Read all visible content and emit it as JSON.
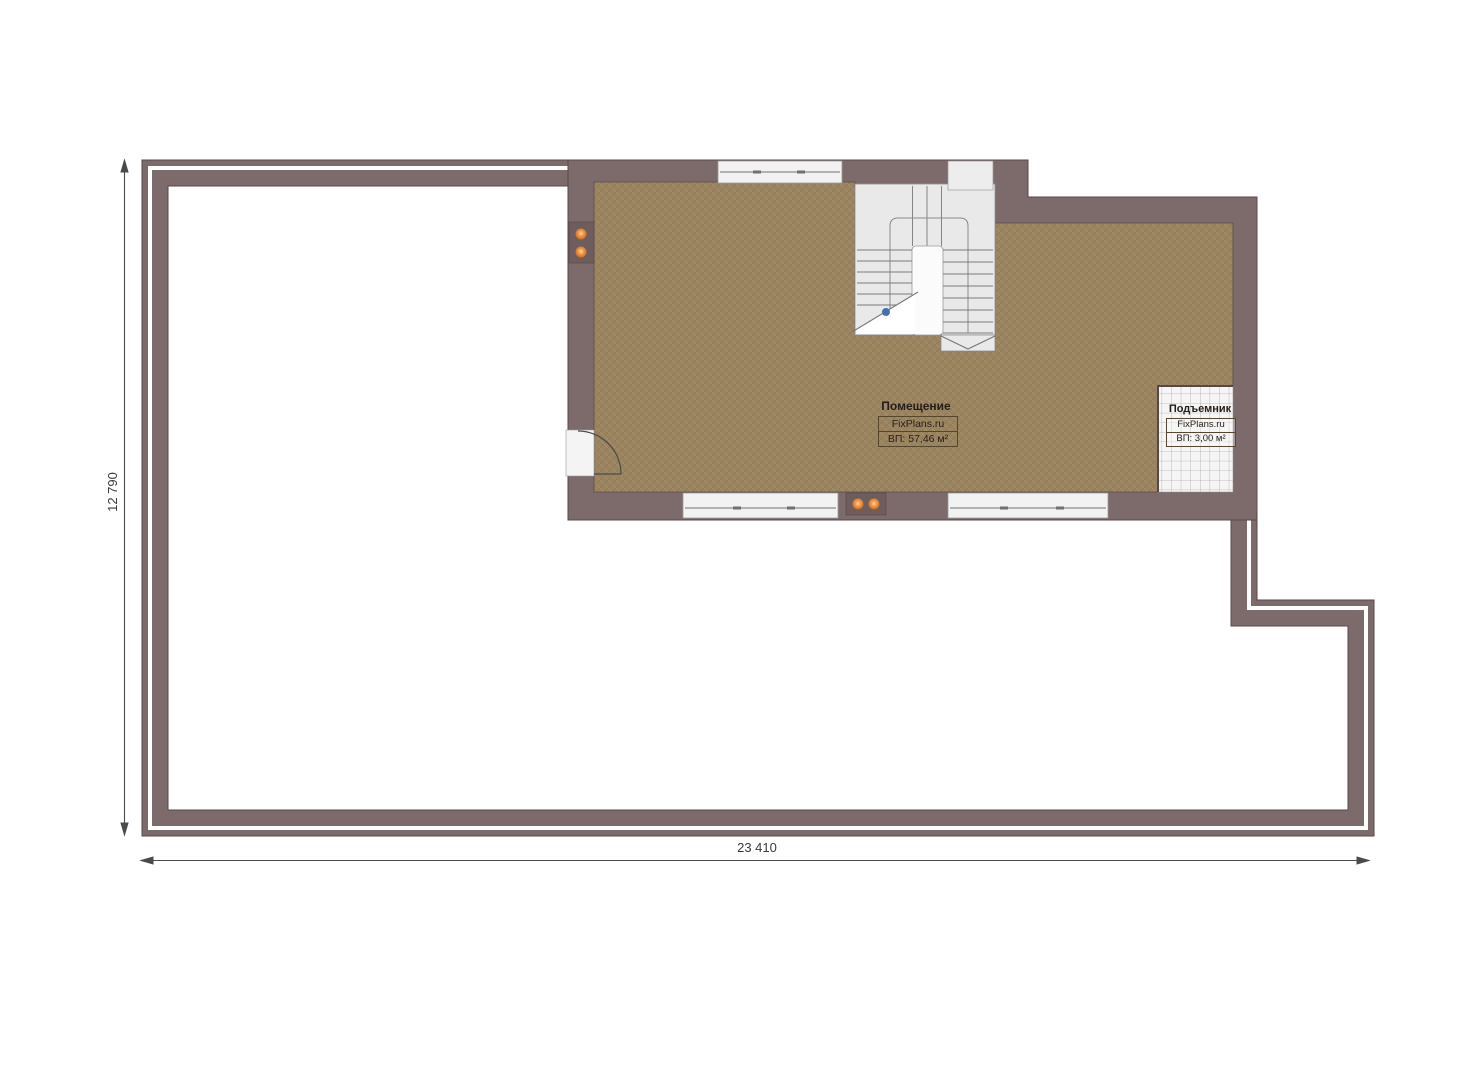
{
  "room": {
    "title": "Помещение",
    "brand": "FixPlans.ru",
    "area": "ВП: 57,46 м²"
  },
  "elevator": {
    "title": "Подъемник",
    "brand": "FixPlans.ru",
    "area": "ВП: 3,00 м²"
  },
  "dimensions": {
    "width_label": "23 410",
    "height_label": "12 790"
  },
  "colors": {
    "wall": "#7d6b6b",
    "wall_outline": "#584a4a",
    "floor": "#9a8460",
    "stair_fill": "#e9e9e9",
    "elevator_grid_bg": "#f5f5f5",
    "outlet": "#e07a2e",
    "dimension_line": "#4a4a4a",
    "stair_marker_blue": "#4472a8"
  }
}
